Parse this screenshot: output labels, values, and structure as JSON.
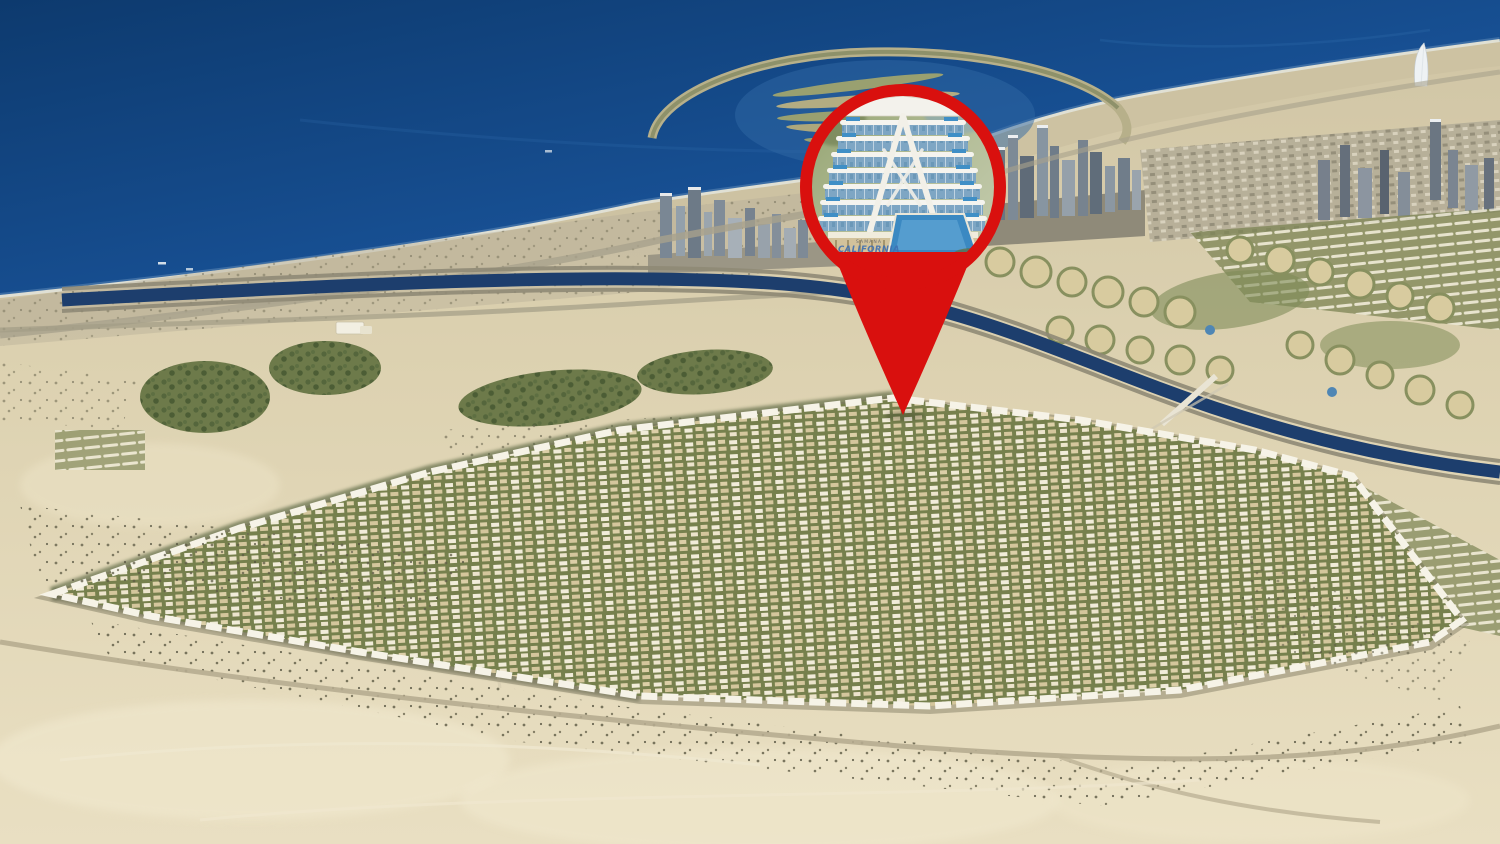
{
  "scene": {
    "kind": "aerial-location-render",
    "description": "Aerial view of Dubai coastline and desert master community with a red location pin highlighting a terraced residential building",
    "colors": {
      "sea": "#14498A",
      "sea_deep": "#0D3A6E",
      "sand": "#DFD5B5",
      "beach": "#CDC2A2",
      "community_green": "#76804D",
      "building_white": "#F1ECD9",
      "building_beige": "#DCCFA7",
      "canal": "#1D3E6D",
      "pin_red": "#D9100E",
      "pool_blue": "#3F8FC6"
    }
  },
  "pin": {
    "accent_color": "#D9100E",
    "building_brand_small": "SAMANA",
    "building_brand": "CALIFORNIA"
  }
}
